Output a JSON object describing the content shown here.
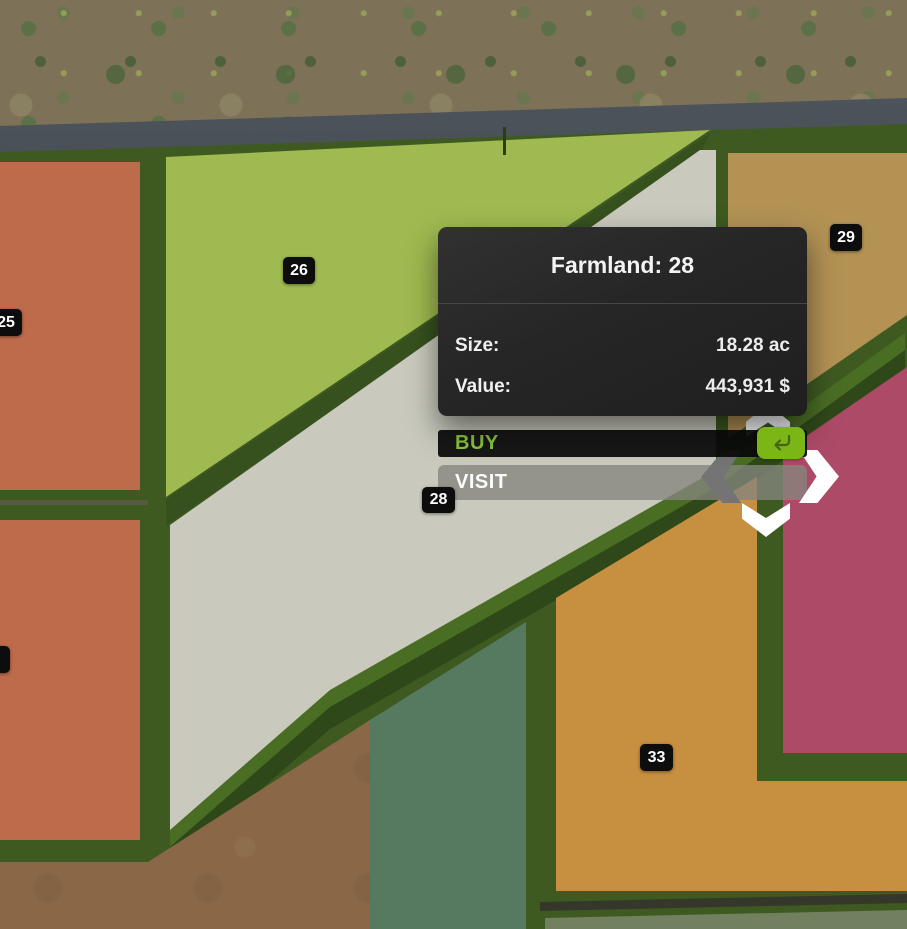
{
  "popup": {
    "title": "Farmland: 28",
    "rows": [
      {
        "label": "Size:",
        "value": "18.28 ac"
      },
      {
        "label": "Value:",
        "value": "443,931 $"
      }
    ],
    "buy_label": "BUY",
    "visit_label": "VISIT"
  },
  "badges": {
    "b25": "25",
    "b26": "26",
    "b28": "28",
    "b29": "29",
    "b33": "33",
    "b7": "7"
  },
  "icons": {
    "enter": "enter-return-icon",
    "nav_up": "chevron-up-icon",
    "nav_down": "chevron-down-icon",
    "nav_left": "chevron-left-icon",
    "nav_right": "chevron-right-icon"
  },
  "colors": {
    "panel_bg": "#282828",
    "bar_black": "#0c0c0c",
    "lime_text": "#8dc63f",
    "lime_button": "#7cb516",
    "visit_gray": "#85857e",
    "badge_bg": "#0d0d0d",
    "border_green": "#3e5a21",
    "border_green_dark": "#37511e",
    "field_green": "#9fba50",
    "field_white": "#c9cabd",
    "field_terracotta": "#bd6b4b",
    "field_tan": "#b39254",
    "field_magenta": "#ad4a67",
    "field_orange": "#c78f40",
    "field_teal": "#567a60",
    "terrain_brown": "#7d7157",
    "terrain_dirt": "#8a6847",
    "road_gray": "#3e444b",
    "arrow_white": "#ffffff",
    "arrow_gray": "#747474"
  }
}
